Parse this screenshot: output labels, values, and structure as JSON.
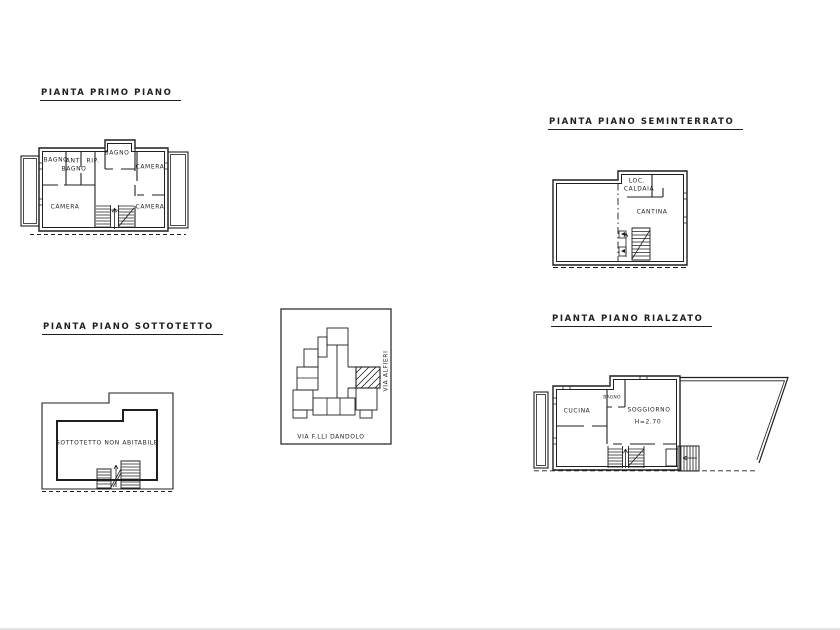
{
  "sheet": {
    "paper": "#ffffff",
    "ink": "#1f1f1f"
  },
  "plans": {
    "primo_piano": {
      "title": "PIANTA PRIMO PIANO",
      "rooms": {
        "bagno_nw": "BAGNO",
        "antibagno_line1": "ANTI",
        "antibagno_line2": "BAGNO",
        "rip": "RIP.",
        "bagno_top": "BAGNO",
        "camera_ne": "CAMERA",
        "camera_sw": "CAMERA",
        "camera_se": "CAMERA",
        "rip_stairs": "RIP"
      }
    },
    "seminterrato": {
      "title": "PIANTA PIANO SEMINTERRATO",
      "rooms": {
        "loc_caldaia_line1": "LOC.",
        "loc_caldaia_line2": "CALDAIA",
        "cantina": "CANTINA"
      }
    },
    "sottotetto": {
      "title": "PIANTA PIANO SOTTOTETTO",
      "rooms": {
        "main": "SOTTOTETTO NON ABITABILE"
      }
    },
    "rialzato": {
      "title": "PIANTA PIANO RIALZATO",
      "rooms": {
        "cucina": "CUCINA",
        "bagno": "BAGNO",
        "soggiorno": "SOGGIORNO",
        "altezza": "H=2.70"
      }
    },
    "site": {
      "street_bottom": "VIA F.LLI DANDOLO",
      "street_right": "VIA ALFIERI"
    }
  }
}
